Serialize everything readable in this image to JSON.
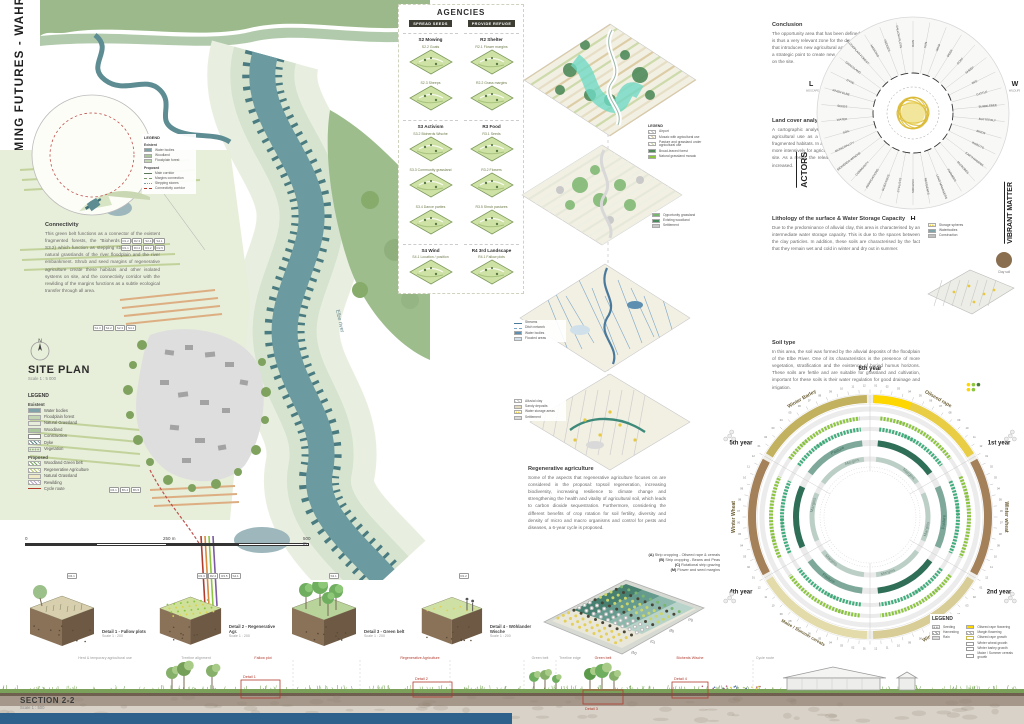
{
  "poster": {
    "title": "2 FARMING FUTURES - WAHRENBERG"
  },
  "palette": {
    "river": "#6b9aa0",
    "dyke": "#4a7b80",
    "accent_red": "#b23b2e",
    "flowering_yellow": "#ffd700",
    "bottom_bar": "#2e618c"
  },
  "site_plan": {
    "north": "N",
    "heading": "SITE PLAN",
    "scale": "Scale 1 : 5 000",
    "river_label": "Elbe river",
    "connectivity": {
      "heading": "Connectivity",
      "body": "This green belt functions as a connector of the existent fragmented forests, the \"Bioherds Wische\" (Agency S3.2) which function as stepping stones, links the two natural grasslands of the river floodplain and the river embankment. Shrub and seed margins of regenerative agriculture create these habitats and other isolated systems on site, and the connectivity corridor with the rewilding of the margins functions as a subtle ecological transfer through all area."
    },
    "chip_groups": [
      [
        "R1.2",
        "R2.3",
        "S2.4",
        "S4.1"
      ],
      [
        "R1.1",
        "R3.2",
        "R4.2",
        "R2.5"
      ],
      [
        "S1.3",
        "S2.2",
        "S2.3",
        "S4.1"
      ],
      [
        "R4.1",
        "Bh.4",
        "Bh.5"
      ]
    ],
    "inset_legend": {
      "title": "LEGEND",
      "existent_label": "Existent",
      "existent": [
        {
          "label": "Water bodies",
          "color": "#7fa3a8",
          "style": "solid"
        },
        {
          "label": "Woodland",
          "color": "#a9c79b",
          "style": "solid"
        },
        {
          "label": "Floodplain forest",
          "color": "#c3d6b4",
          "style": "solid"
        }
      ],
      "proposed_label": "Proposed",
      "proposed": [
        {
          "label": "Main corridor",
          "color": "#5a7a5a",
          "style": "line"
        },
        {
          "label": "Margins connection",
          "color": "#7a9a6a",
          "style": "dashed-line"
        },
        {
          "label": "Stepping stones",
          "color": "#7aa0a8",
          "style": "dotted-line"
        },
        {
          "label": "Connectivity corridor",
          "color": "#b23b2e",
          "style": "dashed-line"
        }
      ]
    },
    "legend": {
      "title": "LEGEND",
      "existent_label": "Existent",
      "existent": [
        {
          "label": "Water bodies",
          "color": "#7fa3a8",
          "style": "solid"
        },
        {
          "label": "Floodplain forest",
          "color": "#c3d6b4",
          "style": "solid"
        },
        {
          "label": "Natural Grassland",
          "color": "#e6edda",
          "style": "solid"
        },
        {
          "label": "Woodland",
          "color": "#a9c79b",
          "style": "solid"
        },
        {
          "label": "Construction",
          "color": "#888888",
          "style": "outline"
        },
        {
          "label": "Dyke",
          "color": "#5f8a8a",
          "style": "stripes"
        },
        {
          "label": "Vegetation",
          "color": "#9ab787",
          "style": "dots"
        }
      ],
      "proposed_label": "Proposed",
      "proposed": [
        {
          "label": "Woodland Green belt",
          "color": "#7aa85f",
          "style": "stripes"
        },
        {
          "label": "Regenerative Agriculture",
          "color": "#b5c96a",
          "style": "stripes"
        },
        {
          "label": "Natural Grassland",
          "color": "#efe9c6",
          "style": "solid"
        },
        {
          "label": "Rewilding",
          "color": "#b9a6c9",
          "style": "stripes"
        },
        {
          "label": "Cycle route",
          "color": "#b23b2e",
          "style": "line"
        }
      ]
    },
    "scalebar": {
      "zero": "0",
      "mid": "250 m",
      "end": "500 m"
    }
  },
  "agencies": {
    "title": "AGENCIES",
    "columns": [
      {
        "header": "SPREAD SEEDS",
        "groups": [
          {
            "title": "S2 Mowing",
            "items": [
              "S2.2 Goats",
              "S2.3 Sheeps"
            ]
          },
          {
            "title": "S3 Activism",
            "items": [
              "S3.2 Bioherds Wische",
              "S3.3 Community grassland",
              "S3.4 Dance parties"
            ]
          },
          {
            "title": "S4 Wind",
            "items": [
              "S4.1 Location / position"
            ]
          }
        ]
      },
      {
        "header": "PROVIDE REFUGE",
        "groups": [
          {
            "title": "R2 Shelter",
            "items": [
              "R2.1 Flower margins",
              "R2.2 Grass margins"
            ]
          },
          {
            "title": "R3 Food",
            "items": [
              "R3.1 Seeds",
              "R3.2 Flowers",
              "R3.5 Shrub pastures"
            ]
          },
          {
            "title": "R4 3rd Landscape",
            "items": [
              "R4.1 Fallow plots"
            ]
          }
        ]
      }
    ]
  },
  "middle_maps": [
    {
      "id": "land-cover-map",
      "legend": {
        "title": "LEGEND",
        "items": [
          {
            "label": "Airport",
            "color": "#bfbfbf",
            "style": "stripes"
          },
          {
            "label": "Mosaic with agricultural use",
            "color": "#d9c79a",
            "style": "stripes"
          },
          {
            "label": "Pasture and grassland under agricultural use",
            "color": "#c7d6a0",
            "style": "stripes"
          },
          {
            "label": "Broad-leaved forest",
            "color": "#4f8a5a",
            "style": "solid"
          },
          {
            "label": "Natural grassland mosaic",
            "color": "#8cc63f",
            "style": "solid"
          }
        ]
      }
    },
    {
      "id": "opportunity-areas-map",
      "legend": {
        "title": "",
        "items": [
          {
            "label": "Opportunity grassland",
            "color": "#7ab56f",
            "style": "solid"
          },
          {
            "label": "Existing woodland",
            "color": "#4a8a5a",
            "style": "solid"
          },
          {
            "label": "Settlement",
            "color": "#c9c9c9",
            "style": "solid"
          }
        ]
      }
    },
    {
      "id": "water-network-map",
      "legend": {
        "title": "",
        "items": [
          {
            "label": "Streams",
            "color": "#4a7a9b",
            "style": "line"
          },
          {
            "label": "Ditch network",
            "color": "#7aa7c7",
            "style": "dashed-line"
          },
          {
            "label": "Water bodies",
            "color": "#5e8fb0",
            "style": "solid"
          },
          {
            "label": "Flooded areas",
            "color": "#cfe0ea",
            "style": "solid"
          }
        ]
      }
    },
    {
      "id": "soil-lithology-map",
      "legend": {
        "title": "",
        "items": [
          {
            "label": "Alluvial clay",
            "color": "#c9c9c9",
            "style": "stripes"
          },
          {
            "label": "Sandy deposits",
            "color": "#e3dbc0",
            "style": "solid"
          },
          {
            "label": "Water storage areas",
            "color": "#e8c93e",
            "style": "dots"
          },
          {
            "label": "Settlement",
            "color": "#d9d9d9",
            "style": "solid"
          }
        ]
      }
    }
  ],
  "regenerative": {
    "heading": "Regenerative agriculture",
    "body": "Some of the aspects that regenerative agriculture focuses on are considered in the proposal: topsoil regeneration, increasing biodiversity, increasing resilience to climate change and strengthening the health and vitality of agricultural soil, which leads to carbon dioxide sequestration. Furthermore, considering the different benefits of crop rotation for soil fertility, diversity and density of micro and macro organisms and control for pests and diseases, a 6-year cycle is proposed.",
    "scheme_legend": [
      {
        "code": "(A)",
        "label": "Strip cropping - Oilseed rape & cereals"
      },
      {
        "code": "(B)",
        "label": "Strip cropping - Beans and Peas"
      },
      {
        "code": "(C)",
        "label": "Rotational strip grazing"
      },
      {
        "code": "(M)",
        "label": "Flower and seed margins"
      }
    ],
    "edge_labels": [
      "(A)",
      "(B)",
      "(C)",
      "(M)"
    ]
  },
  "right_column": {
    "conclusion": {
      "heading": "Conclusion",
      "body": "The opportunity area that has been defined in the surroundings of Wahrenberg is thus a very relevant zone for the development of a new landscape scenario, that introduces new agricultural approaches to improve soil quality, as well as a strategic point to create new ecological connections to increase biodiversity on the site."
    },
    "land_cover": {
      "heading": "Land cover analysis - Opportunity areas",
      "body": "A cartographic analysis shows the capacity of the grassland area under agricultural use as a potential ecological connector between the existing fragmented habitats. In addition, the measures being taken to use ground soils more intensively for agriculture have led to a steady degradation of soil on the site. As a result, the release of carbon dioxide along with other gases has increased."
    },
    "lithology": {
      "heading": "Lithology of the surface & Water Storage Capacity",
      "body": "Due to the predominance of alluvial clay, this area is characterised by an intermediate water storage capacity. This is due to the spaces between the clay particles. In addition, these soils are characterised by the fact that they remain wet and cold in winter and dry out in summer.",
      "legend": [
        {
          "label": "Storage spheres",
          "color": "#e8c93e",
          "style": "dots"
        },
        {
          "label": "Waterbodies",
          "color": "#7fa3a8",
          "style": "solid"
        },
        {
          "label": "Construction",
          "color": "#bfbfbf",
          "style": "solid"
        }
      ],
      "sphere_caption": "Clay soil"
    },
    "soil_type": {
      "heading": "Soil type",
      "body": "In this area, the soil was formed by the alluvial deposits of the floodplain of the Elbe River. One of its characteristics is the presence of more vegetation, stratification and the existence of buried humus horizons. These soils are fertile and are suitable for grassland and cultivation, important for these soils is their water regulation for good drainage and irrigation."
    }
  },
  "chart_data": {
    "actors_wheel": {
      "type": "radial-diagram",
      "label": "ACTORS",
      "side_label": "VIBRANT MATTER",
      "axes": [
        {
          "key": "L",
          "sub": "LANDSCAPE",
          "angle": 196
        },
        {
          "key": "W",
          "sub": "WILDLIFE",
          "angle": -16
        },
        {
          "key": "H",
          "sub": "HUMAN",
          "angle": 90
        }
      ],
      "spokes": [
        "RAIN",
        "SUN",
        "WIND",
        "DEER",
        "GOAT",
        "SHEEP",
        "BEE",
        "CATTLE",
        "BUMBLEBEE",
        "BUTTERFLY",
        "BIRDS",
        "INSECTS",
        "EARTHWORMS",
        "MICROBES",
        "FARMERS",
        "LAND MANAGERS",
        "RESIDENTS",
        "VISITORS",
        "CYCLISTS",
        "SCIENTISTS",
        "ASSOCIATIONS",
        "COMMUNITY",
        "BIOHERDS WISCHE",
        "MUNICIPALITY",
        "SOIL",
        "WATER",
        "SEEDS",
        "RIVER ELBE",
        "DYKE",
        "GRASSLAND",
        "FLOODPLAIN FOREST",
        "MARGINS",
        "HEDGES",
        "FALLOW PLOTS"
      ]
    },
    "crop_wheel": {
      "type": "radial-crop-calendar",
      "title": "6-year crop rotation wheel",
      "sectors": [
        {
          "year": "6th year",
          "start": -90,
          "crop": "Oilseed rape",
          "color": "#e8cd45"
        },
        {
          "year": "1st year",
          "start": -30,
          "crop": "Winter wheat",
          "color": "#a5815a"
        },
        {
          "year": "2nd year",
          "start": 30,
          "crop": "Winter Barley",
          "color": "#d8cd96"
        },
        {
          "year": "3th year",
          "start": 90,
          "crop": "Maize / Summer cereals",
          "color": "#e3dbaa"
        },
        {
          "year": "4th year",
          "start": 150,
          "crop": "Winter Wheat",
          "color": "#a5815a"
        },
        {
          "year": "5th year",
          "start": 210,
          "crop": "Winter Barley",
          "color": "#c2b15e"
        }
      ],
      "flowering": {
        "label": "Oilseed rape flowering",
        "start": -88,
        "end": -70,
        "color": "#ffd700"
      },
      "rings": [
        {
          "name": "Field",
          "r": 99,
          "color": "#8cc63f",
          "text": "#7db53a",
          "w": 4,
          "dash": "2 1.3"
        },
        {
          "name": "Beans",
          "r": 88,
          "color": "#3fae7c",
          "text": "#2f9c69",
          "w": 4,
          "dash": "2 1.3"
        },
        {
          "name": "Pasture",
          "r": 74,
          "colors": [
            "#2f6e57",
            "#7ea99a"
          ],
          "text": "#3c6b5a",
          "w": 6
        },
        {
          "name": "Margins",
          "r": 58,
          "color": "#bccfc6",
          "text": "#6d8a80",
          "w": 5
        }
      ],
      "months": [
        "01",
        "02",
        "03",
        "04",
        "05",
        "06",
        "07",
        "08",
        "09",
        "10",
        "11",
        "12"
      ],
      "legend": {
        "title": "LEGEND",
        "items_left": [
          {
            "label": "Seeding",
            "color": "#9a9a9a",
            "style": "dots"
          },
          {
            "label": "Harvesting",
            "color": "#9a9a9a",
            "style": "stripes"
          },
          {
            "label": "Rain",
            "color": "#d9d9d9",
            "style": "solid"
          }
        ],
        "items_right": [
          {
            "label": "Oilseed rape flowering",
            "color": "#ffd700",
            "style": "solid"
          },
          {
            "label": "Margin flowering",
            "color": "#aaaaaa",
            "style": "stripes"
          },
          {
            "label": "Oilseed rape growth",
            "color": "#c9b84a",
            "style": "outline"
          },
          {
            "label": "Winter wheat growth",
            "color": "#999999",
            "style": "outline"
          },
          {
            "label": "Winter barley growth",
            "color": "#999999",
            "style": "outline"
          },
          {
            "label": "Maize / Summer cereals growth",
            "color": "#999999",
            "style": "outline"
          }
        ]
      }
    }
  },
  "details": [
    {
      "title": "Detail 1 - Fallow plots",
      "scale": "Scale 1 : 200",
      "chips": [
        "R4.1"
      ]
    },
    {
      "title": "Detail 2 - Regenerative Agr.",
      "scale": "Scale 1 : 200",
      "chips": [
        "R1.3",
        "R2.2",
        "R3.5",
        "S4.1"
      ]
    },
    {
      "title": "Detail 3 - Green belt",
      "scale": "Scale 1 : 200",
      "chips": [
        "S3.1"
      ]
    },
    {
      "title": "Detail 4 - Wöhlander Wische",
      "scale": "Scale 1 : 200",
      "chips": [
        "R1.2"
      ]
    }
  ],
  "section": {
    "title": "SECTION 2-2",
    "scale": "Scale 1 : 500",
    "labels": [
      {
        "text": "Herd & temporary agricultural use",
        "tone": "gray",
        "x": 105
      },
      {
        "text": "Treeline alignment",
        "tone": "gray",
        "x": 196
      },
      {
        "text": "Fallow plot",
        "tone": "red",
        "x": 263
      },
      {
        "text": "Regenerative Agriculture",
        "tone": "red",
        "x": 420
      },
      {
        "text": "Green belt",
        "tone": "gray",
        "x": 540
      },
      {
        "text": "Treeline edge",
        "tone": "gray",
        "x": 570
      },
      {
        "text": "Green belt",
        "tone": "red",
        "x": 603
      },
      {
        "text": "Bioherds Wische",
        "tone": "red",
        "x": 690
      },
      {
        "text": "Cycle route",
        "tone": "gray",
        "x": 765
      }
    ],
    "detail_boxes": [
      {
        "label": "Detail 1",
        "x": 241,
        "y": 28,
        "w": 39,
        "h": 18,
        "label_above": true
      },
      {
        "label": "Detail 2",
        "x": 413,
        "y": 30,
        "w": 39,
        "h": 15,
        "label_above": true
      },
      {
        "label": "Detail 3",
        "x": 583,
        "y": 38,
        "w": 40,
        "h": 14,
        "label_above": false
      },
      {
        "label": "Detail 4",
        "x": 672,
        "y": 30,
        "w": 36,
        "h": 16,
        "label_above": true
      }
    ]
  }
}
